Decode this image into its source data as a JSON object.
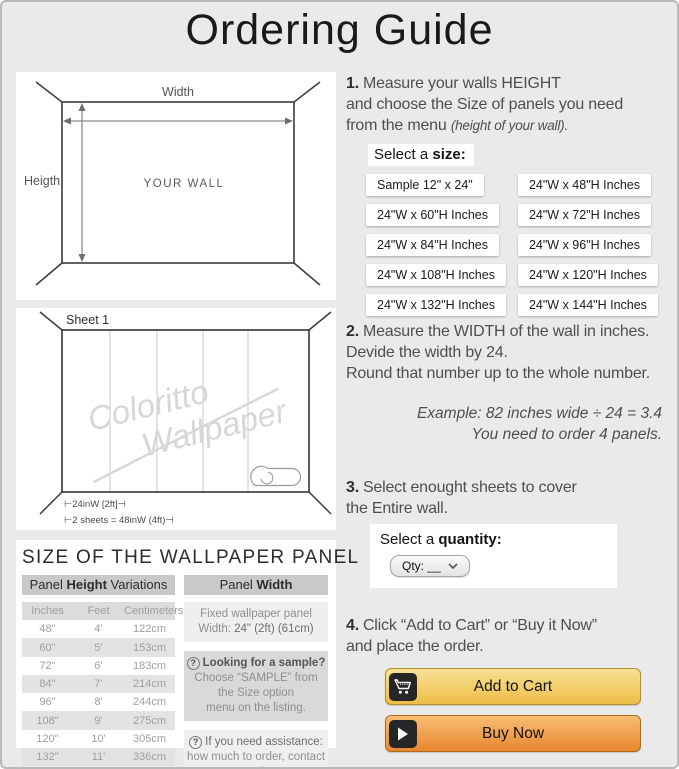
{
  "title": "Ordering Guide",
  "colors": {
    "background": "#eaeaea",
    "panel": "#ffffff",
    "add_to_cart_top": "#f8e196",
    "add_to_cart_bottom": "#eebd47",
    "buy_now_top": "#f7bd72",
    "buy_now_bottom": "#e8872f",
    "icon_tile": "#262626",
    "header_bar": "#c9c9c9",
    "table_alt_row": "#e3e3e3"
  },
  "wall_diagram": {
    "width_label": "Width",
    "height_label": "Heigth",
    "center_label": "YOUR WALL"
  },
  "sheet_diagram": {
    "sheet_label": "Sheet 1",
    "watermark_line1": "Coloritto",
    "watermark_line2": "Wallpaper",
    "measure_top": "⊢24inW [2ft]⊣",
    "measure_bottom": "⊢2 sheets = 48inW (4ft)⊣"
  },
  "steps": {
    "step1": {
      "num": "1.",
      "line1": "Measure your walls HEIGHT",
      "line2": "and choose the Size of panels you need",
      "line3": "from the menu ",
      "line3_note": "(height of your wall).",
      "select_label_prefix": "Select a ",
      "select_label_bold": "size:",
      "sizes": [
        "Sample 12\" x 24\"",
        "24\"W x 48\"H Inches",
        "24\"W x 60\"H Inches",
        "24\"W x 72\"H Inches",
        "24\"W x 84\"H Inches",
        "24\"W x 96\"H Inches",
        "24\"W x 108\"H Inches",
        "24\"W x 120\"H Inches",
        "24\"W x 132\"H Inches",
        "24\"W x 144\"H Inches"
      ]
    },
    "step2": {
      "num": "2.",
      "line1": "Measure the WIDTH of the wall in inches.",
      "line2": "Devide the width by 24.",
      "line3": "Round that number up to the whole number.",
      "example_line1": "Example: 82 inches wide ÷ 24 = 3.4",
      "example_line2": "You need to order 4 panels."
    },
    "step3": {
      "num": "3.",
      "line1": "Select enought sheets to cover",
      "line2": "the Entire wall.",
      "select_label_prefix": "Select a ",
      "select_label_bold": "quantity:",
      "qty_label": "Qty: __"
    },
    "step4": {
      "num": "4.",
      "line1": "Click “Add to Cart” or “Buy it Now”",
      "line2": "and place the order.",
      "add_to_cart": "Add to Cart",
      "buy_now": "Buy Now"
    }
  },
  "panel_info": {
    "heading": "SIZE OF THE WALLPAPER PANEL",
    "height_header": {
      "prefix": "Panel ",
      "bold": "Height",
      "suffix": " Variations"
    },
    "width_header": {
      "prefix": "Panel ",
      "bold": "Width"
    },
    "table": {
      "columns": [
        "Inches",
        "Feet",
        "Centimeters"
      ],
      "rows": [
        [
          "48\"",
          "4'",
          "122cm"
        ],
        [
          "60\"",
          "5'",
          "153cm"
        ],
        [
          "72\"",
          "6'",
          "183cm"
        ],
        [
          "84\"",
          "7'",
          "214cm"
        ],
        [
          "96\"",
          "8'",
          "244cm"
        ],
        [
          "108\"",
          "9'",
          "275cm"
        ],
        [
          "120\"",
          "10'",
          "305cm"
        ],
        [
          "132\"",
          "11'",
          "336cm"
        ],
        [
          "144\"",
          "12'",
          "366cm"
        ]
      ]
    },
    "fixed_width": {
      "line1": "Fixed wallpaper panel",
      "line2_prefix": "Width: ",
      "line2_value": "24\" (2ft) (61cm)"
    },
    "sample_note": {
      "icon": "?",
      "line1": "Looking for a sample?",
      "line2": "Choose “SAMPLE” from",
      "line3": "the Size option",
      "line4": "menu on the listing."
    },
    "assistance_note": {
      "icon": "?",
      "line1": "If you need assistance:",
      "line2": "how much to order, contact us!"
    }
  }
}
